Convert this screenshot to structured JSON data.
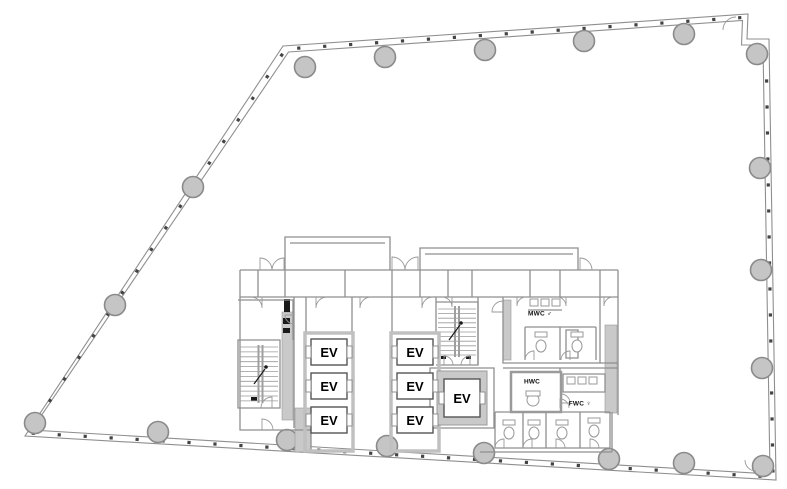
{
  "plan": {
    "background": "#ffffff",
    "colors": {
      "wall": "#8f8f8f",
      "wall_thin": "#9a9a9a",
      "shaft_wall": "#c0c0c0",
      "gray_fill": "#c9c9c9",
      "column_fill": "#c5c5c5",
      "column_stroke": "#8a8a8a",
      "tick": "#444444",
      "dark": "#1a1a1a",
      "text": "#000000"
    },
    "outline": {
      "outer": "M283,46 L748,14 L747,39 L769,39 L776,480 L25,436 Z",
      "inner": "M288.5,52 L742.5,20.5 L741.5,45 L763,45 L770,474 L31.5,430 Z",
      "tick_spacing": 26,
      "tick_edges": [
        [
          285.8,
          49,
          745.3,
          17.3
        ],
        [
          766,
          42,
          773,
          477
        ],
        [
          773,
          477,
          28.3,
          433
        ],
        [
          28.3,
          433,
          285.8,
          49
        ]
      ]
    },
    "columns": {
      "radius": 10.5,
      "centers": [
        [
          305,
          67
        ],
        [
          385,
          57
        ],
        [
          485,
          50
        ],
        [
          584,
          41
        ],
        [
          684,
          34
        ],
        [
          757,
          54
        ],
        [
          760,
          168
        ],
        [
          761,
          270
        ],
        [
          762,
          368
        ],
        [
          763,
          466
        ],
        [
          684,
          463
        ],
        [
          609,
          459
        ],
        [
          484,
          453
        ],
        [
          387,
          446
        ],
        [
          287,
          440
        ],
        [
          158,
          432
        ],
        [
          35,
          423
        ],
        [
          115,
          305
        ],
        [
          193,
          187
        ]
      ]
    },
    "gray_rects": [
      [
        282,
        312,
        11,
        108
      ],
      [
        503,
        300,
        8,
        60
      ],
      [
        605,
        325,
        12,
        88
      ],
      [
        295,
        408,
        16,
        44
      ]
    ],
    "black_rects": [
      [
        284,
        299,
        6,
        13
      ],
      [
        283,
        318,
        7,
        6
      ],
      [
        283,
        328,
        7,
        5
      ],
      [
        251,
        397,
        6,
        4
      ],
      [
        441,
        356,
        5,
        3
      ],
      [
        466,
        356,
        5,
        3
      ]
    ],
    "walls": [
      "M240,270 H618",
      "M240,297 H618",
      "M240,270 V430 H311 V452",
      "M618,270 V415",
      "M285,270 V237 H390 V270",
      "M290,243 H385",
      "M420,270 V248 H578 V270",
      "M425,254 H573",
      "M258,270 V297",
      "M285,270 V297",
      "M345,270 V297",
      "M392,270 V297",
      "M420,270 V297",
      "M448,270 V297",
      "M472,270 V297",
      "M530,270 V297",
      "M560,270 V297",
      "M600,270 V297",
      "M238,300 H293 V340",
      "M294,297 V428",
      "M238,340 H280 V408 H238 Z",
      "M306,297 V333 H352",
      "M352,297 V333",
      "M392,297 V333 H436",
      "M436,297 V333",
      "M436,302 H478 V365 H436",
      "M430,368 H494 V428 H430 Z",
      "M478,297 V365",
      "M503,297 V363 H600 V297",
      "M600,363 H618",
      "M528,310 H562",
      "M525,327 H596",
      "M525,327 V360",
      "M560,327 V360",
      "M596,327 V360",
      "M566,330 H578 V358 H566 Z",
      "M503,368 H618",
      "M560,368 V412",
      "M563,374 H605 V392 H563 Z",
      "M495,412 H610",
      "M495,412 V448 H610 V412",
      "M523,412 V448",
      "M546,412 V448",
      "M580,412 V448",
      "M480,452 H612",
      "M612,412 V452"
    ],
    "hwc_room": [
      511,
      372,
      50,
      40
    ],
    "fixture_squares": [
      [
        530,
        299,
        8,
        7
      ],
      [
        541,
        299,
        8,
        7
      ],
      [
        552,
        299,
        8,
        7
      ],
      [
        567,
        377,
        8,
        7
      ],
      [
        578,
        377,
        8,
        7
      ],
      [
        589,
        377,
        8,
        7
      ]
    ],
    "toilets": {
      "bowls": [
        [
          541,
          346,
          5,
          6
        ],
        [
          577,
          346,
          5,
          6
        ],
        [
          533,
          400,
          6,
          6
        ],
        [
          509,
          433,
          5,
          6
        ],
        [
          534,
          433,
          5,
          6
        ],
        [
          562,
          433,
          5,
          6
        ],
        [
          594,
          431,
          5,
          6
        ]
      ],
      "tanks": [
        [
          535,
          332,
          12,
          5
        ],
        [
          571,
          332,
          12,
          5
        ],
        [
          526,
          391,
          14,
          5
        ],
        [
          503,
          420,
          12,
          5
        ],
        [
          528,
          420,
          12,
          5
        ],
        [
          556,
          420,
          12,
          5
        ],
        [
          588,
          418,
          12,
          5
        ]
      ]
    },
    "door_arcs": [
      "M262,297 L262,308 A11,11 0 0 0 251,297",
      "M316,297 L316,308 A11,11 0 0 1 327,297",
      "M360,297 L360,308 A11,11 0 0 1 371,297",
      "M422,297 L422,308 A11,11 0 0 1 433,297",
      "M452,297 L452,307 A10,10 0 0 0 442,297",
      "M517,297 L517,306 A9,9 0 0 1 526,297",
      "M566,297 L566,306 A9,9 0 0 0 557,297",
      "M604,297 L604,306 A9,9 0 0 1 613,297",
      "M260,270 L260,258 A12,12 0 0 1 272,270",
      "M284,270 L284,258 A12,12 0 0 0 272,270",
      "M392,270 L392,257 A13,13 0 0 1 405,270",
      "M418,270 L418,257 A13,13 0 0 0 405,270",
      "M580,270 L580,258 A12,12 0 0 1 592,270",
      "M272,408 L272,397 A11,11 0 0 0 261,408",
      "M262,430 L262,419 A11,11 0 0 1 273,430",
      "M444,365 L444,356 A9,9 0 0 1 453,365",
      "M470,365 L470,356 A9,9 0 0 0 461,365",
      "M503,312 L492,312 A11,11 0 0 1 503,301",
      "M294,315 L285,315 A9,9 0 0 0 294,324",
      "M561,403 L570,403 A9,9 0 0 0 561,394",
      "M560,408 L560,399 A9,9 0 0 1 569,408",
      "M534,360 L534,351 A9,9 0 0 0 525,360",
      "M570,360 L570,351 A9,9 0 0 0 561,360",
      "M504,448 L504,439 A9,9 0 0 0 495,448",
      "M532,448 L532,439 A9,9 0 0 0 523,448",
      "M556,448 L556,439 A9,9 0 0 1 565,448",
      "M590,448 L590,439 A9,9 0 0 1 599,448",
      "M736,17 A13,13 0 0 0 723,30",
      "M745,460 A11,11 0 0 0 756,471"
    ],
    "stairs": [
      {
        "x1": 240,
        "x2": 278,
        "y_start": 347,
        "dy": 4.9,
        "n": 12,
        "rails": [
          258.5,
          262.5
        ],
        "rail_y": [
          345,
          403
        ],
        "arrow": "M254,384 L265,369",
        "dot": [
          266,
          367
        ]
      },
      {
        "x1": 438,
        "x2": 476,
        "y_start": 309,
        "dy": 4.6,
        "n": 11,
        "rails": [
          455,
          459
        ],
        "rail_y": [
          306,
          357
        ],
        "arrow": "M449,340 L460,325",
        "dot": [
          461,
          323
        ]
      }
    ],
    "elevators": {
      "banks": [
        [
          305,
          333,
          48,
          118
        ],
        [
          391,
          333,
          48,
          118
        ]
      ],
      "service_ring": [
        437,
        371,
        50,
        54
      ],
      "cars": [
        {
          "label": "EV",
          "x": 311,
          "y": 339,
          "w": 36,
          "h": 26
        },
        {
          "label": "EV",
          "x": 311,
          "y": 373,
          "w": 36,
          "h": 26
        },
        {
          "label": "EV",
          "x": 311,
          "y": 407,
          "w": 36,
          "h": 26
        },
        {
          "label": "EV",
          "x": 397,
          "y": 339,
          "w": 36,
          "h": 26
        },
        {
          "label": "EV",
          "x": 397,
          "y": 373,
          "w": 36,
          "h": 26
        },
        {
          "label": "EV",
          "x": 397,
          "y": 407,
          "w": 36,
          "h": 26
        },
        {
          "label": "EV",
          "x": 444,
          "y": 379,
          "w": 36,
          "h": 38
        }
      ]
    },
    "room_labels": [
      {
        "text": "MWC ♂",
        "x": 540,
        "y": 314
      },
      {
        "text": "HWC",
        "x": 532,
        "y": 382
      },
      {
        "text": "FWC ♀",
        "x": 580,
        "y": 404
      }
    ]
  }
}
